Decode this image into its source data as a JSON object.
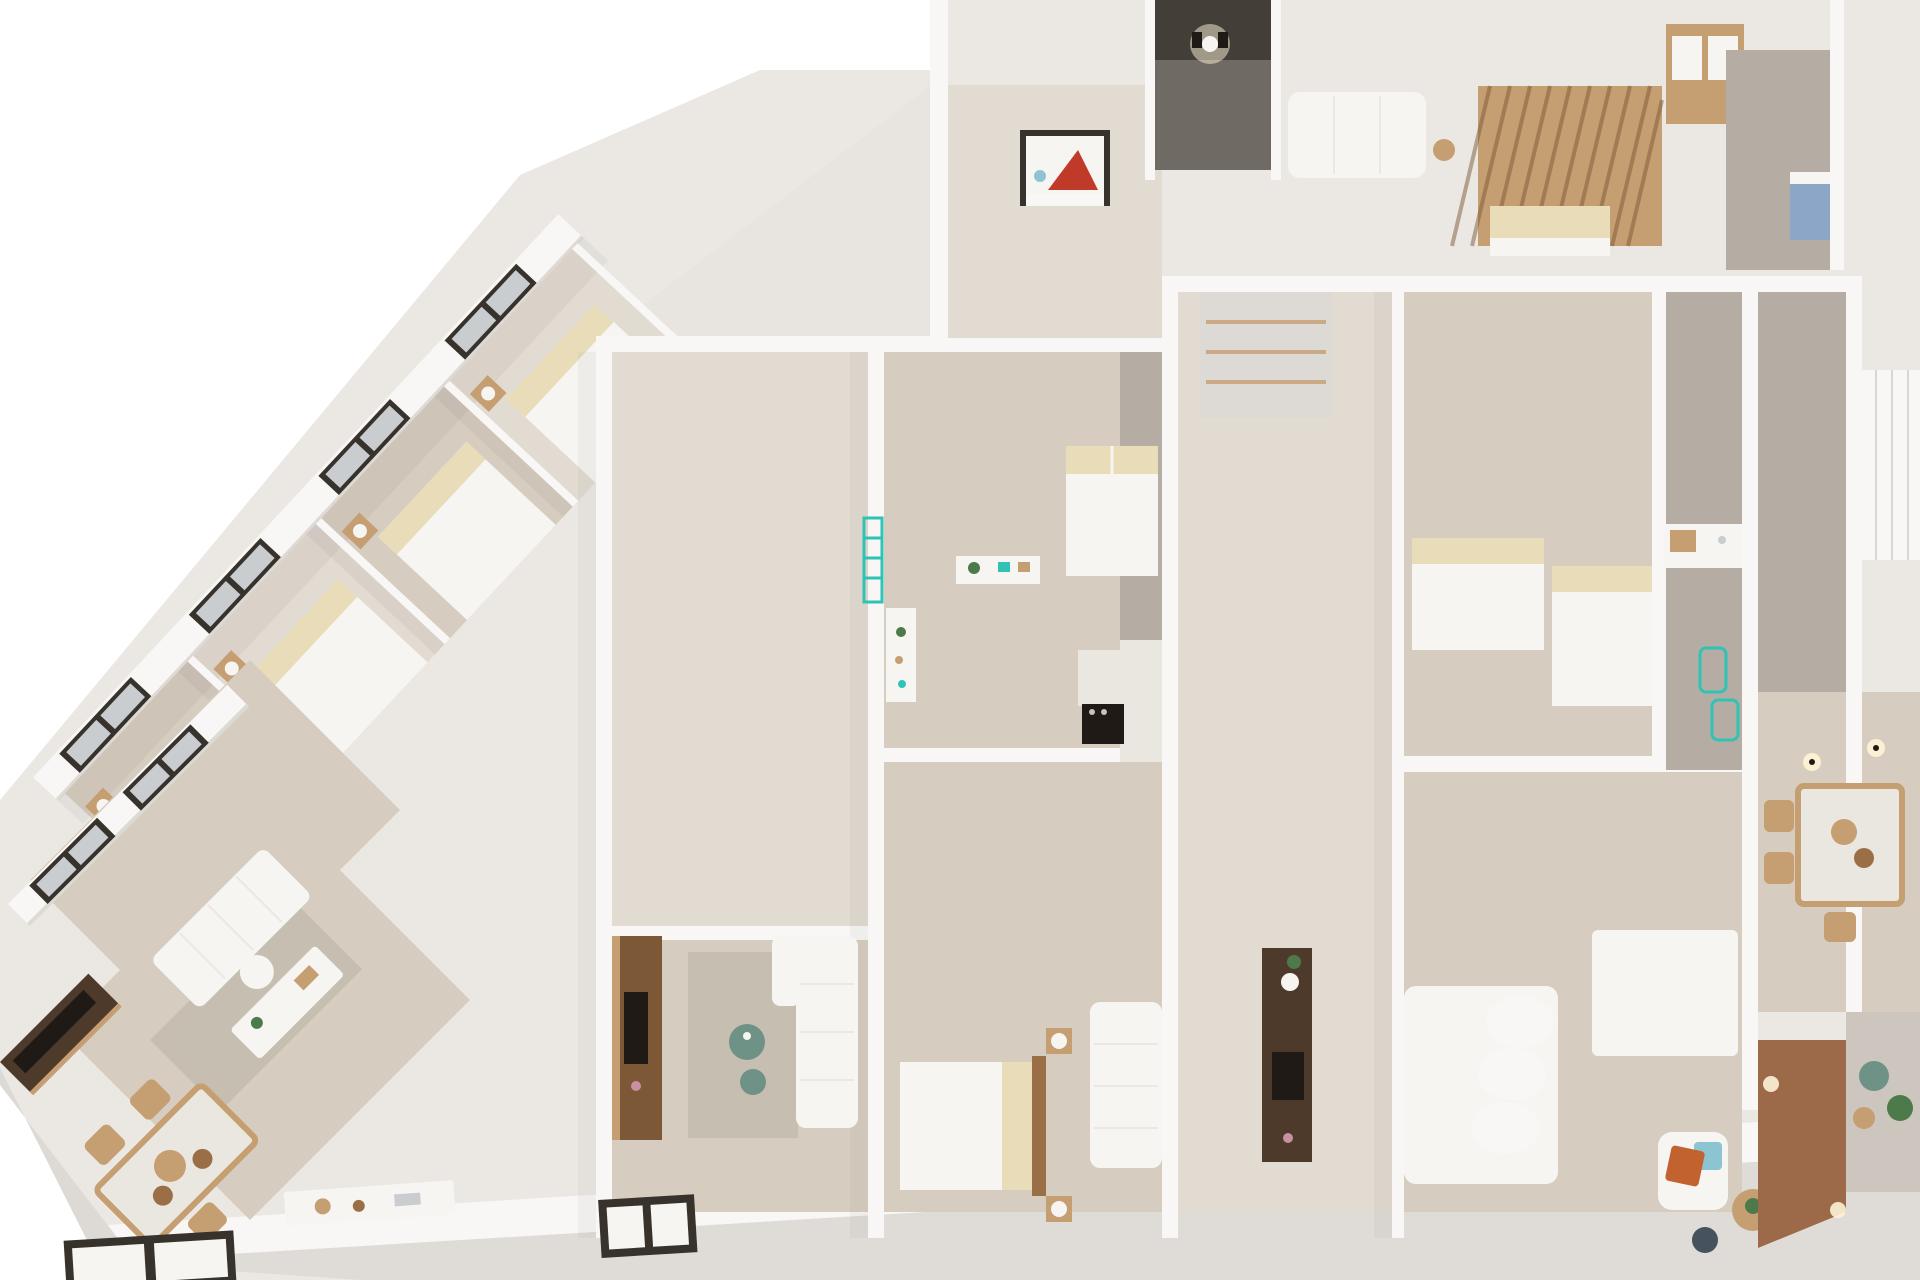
{
  "meta": {
    "title": "3D apartment floor plan render",
    "view": "isometric cutaway from above",
    "background": "#ffffff"
  },
  "palette": {
    "background": "#ffffff",
    "slab": "#ebe8e4",
    "facade": "#dfdcd8",
    "roof_plane": "#e8e5e1",
    "wall": "#f8f7f5",
    "wall_shade": "#dddad6",
    "wall_dark": "#c6c2bd",
    "floor_beige": "#d6ccbf",
    "floor_pale": "#e2dbd1",
    "floor_gray": "#b5ada3",
    "rug": "#c7beb2",
    "marble": "#eae7e1",
    "glass": "#c9cdd0",
    "frame": "#38322c",
    "wood": "#c59e72",
    "wood_dark": "#9a6f45",
    "wood_deep": "#7c5836",
    "walnut": "#4d3a2b",
    "terracotta": "#9c6a49",
    "teal": "#30c3b5",
    "teal_deep": "#18988c",
    "cream": "#e8dcb9",
    "white_soft": "#f6f5f2",
    "black": "#1f1a15",
    "art_red": "#bf3a28",
    "accent_orange": "#c2622f",
    "accent_teal_light": "#8cc4d2",
    "cabinet_blue": "#8ba6c6",
    "accent_pink": "#c98fa2",
    "plant": "#4d7a4a",
    "pouf_green": "#6f9287",
    "pouf_dark": "#46525e",
    "gravel": "#ccc6bf",
    "shadow": "#6f6a63",
    "lamp_glow": "#fff3d6"
  },
  "scene": {
    "areas": [
      {
        "id": "left-wing-bedrooms",
        "label": "row of bedrooms along diagonal facade"
      },
      {
        "id": "left-living-room",
        "label": "living room with sofa and desk"
      },
      {
        "id": "left-dining-area",
        "label": "dining table with chairs"
      },
      {
        "id": "left-kitchenette",
        "label": "counter along bottom wall"
      },
      {
        "id": "central-living-room",
        "label": "living room with TV wall and sofa"
      },
      {
        "id": "central-bedroom-upper",
        "label": "bedroom with double bed"
      },
      {
        "id": "central-bedroom-lower",
        "label": "bedroom with bed, headboard and sofa"
      },
      {
        "id": "central-kitchen",
        "label": "kitchen with marble counter and oven"
      },
      {
        "id": "stair-core-west",
        "label": "turquoise staircase"
      },
      {
        "id": "stair-core-east",
        "label": "turquoise staircase with wood slat screen"
      },
      {
        "id": "twin-bedroom-east",
        "label": "bedroom with two single beds"
      },
      {
        "id": "bathroom-east",
        "label": "bathroom with vanity and towel ladders"
      },
      {
        "id": "living-room-east",
        "label": "living room with large sofa and armchair"
      },
      {
        "id": "dining-area-east",
        "label": "dining table with wooden chairs"
      },
      {
        "id": "entry-hall-east",
        "label": "entry hall with terracotta floor"
      },
      {
        "id": "terrace-east",
        "label": "gravel terrace with poufs"
      },
      {
        "id": "top-corridor",
        "label": "dark corridor with wall sconce"
      },
      {
        "id": "canopy-bedroom",
        "label": "bedroom under wood slat canopy"
      },
      {
        "id": "wardrobe-closets",
        "label": "wardrobe and closet units"
      }
    ],
    "objects": [
      {
        "id": "double-bed",
        "label": "bed with white duvet and cream pillows"
      },
      {
        "id": "single-bed",
        "label": "single bed with cream pillows"
      },
      {
        "id": "nightstand-lamp",
        "label": "wooden nightstand with round lamp"
      },
      {
        "id": "white-sofa",
        "label": "white fabric sofa"
      },
      {
        "id": "armchair-orange",
        "label": "armchair with orange and teal cushions"
      },
      {
        "id": "dining-table-marble",
        "label": "marble top dining table with wood frame"
      },
      {
        "id": "wood-chair",
        "label": "wooden dining chair"
      },
      {
        "id": "tv-wall-walnut",
        "label": "dark walnut media wall with TV"
      },
      {
        "id": "sideboard-tv",
        "label": "walnut sideboard with TV, vase and plant"
      },
      {
        "id": "teal-staircase",
        "label": "turquoise painted staircase"
      },
      {
        "id": "teal-ladder",
        "label": "turquoise wall ladder"
      },
      {
        "id": "towel-ladder",
        "label": "turquoise towel rail"
      },
      {
        "id": "wood-slat-screen",
        "label": "vertical wood slat partition"
      },
      {
        "id": "wood-slat-canopy",
        "label": "wood slat bed canopy"
      },
      {
        "id": "kitchen-island",
        "label": "marble kitchen counter with black oven"
      },
      {
        "id": "desk-chair",
        "label": "desk with white chair"
      },
      {
        "id": "wall-art-red",
        "label": "framed artwork with red accent"
      },
      {
        "id": "wall-sconce",
        "label": "glowing wall sconce"
      },
      {
        "id": "coffee-table-green",
        "label": "round green glass coffee table"
      },
      {
        "id": "plant-pot",
        "label": "green potted plant"
      },
      {
        "id": "vanity-sink",
        "label": "white vanity with wooden box"
      },
      {
        "id": "blue-cabinet",
        "label": "blue laundry cabinet"
      },
      {
        "id": "terrace-pouf",
        "label": "round outdoor pouf"
      },
      {
        "id": "window-dark-frame",
        "label": "dark framed window"
      },
      {
        "id": "kitchen-counter-food",
        "label": "counter with bread and bowls"
      },
      {
        "id": "rug",
        "label": "area rug"
      }
    ]
  }
}
